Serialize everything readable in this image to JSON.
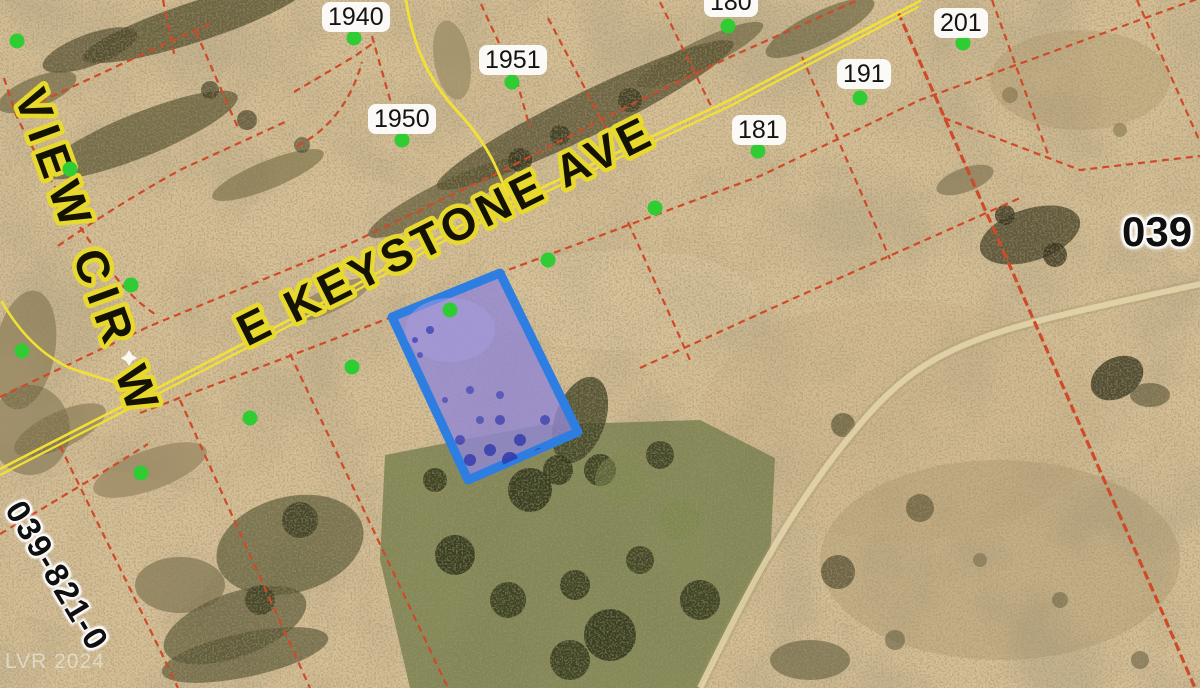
{
  "map": {
    "streets": {
      "keystone": "E KEYSTONE AVE",
      "view_cir": "VIEW CIR W"
    },
    "parcel_labels": [
      {
        "text": "1940"
      },
      {
        "text": "1951"
      },
      {
        "text": "1950"
      },
      {
        "text": "180"
      },
      {
        "text": "201"
      },
      {
        "text": "191"
      },
      {
        "text": "181"
      }
    ],
    "district_label": "039",
    "apn_partial": "039-821-0",
    "watermark": "LVR 2024",
    "colors": {
      "ground": "#d7c096",
      "parcel_line": "#ce4a28",
      "road_line": "#f2e135",
      "street_text": "#141203",
      "street_halo": "#e8d92f",
      "point_marker": "#2fcc33",
      "selected_fill": "#9187d4",
      "selected_stroke": "#2e7ee2",
      "label_text": "#141414",
      "label_bg": "#ffffff"
    }
  }
}
